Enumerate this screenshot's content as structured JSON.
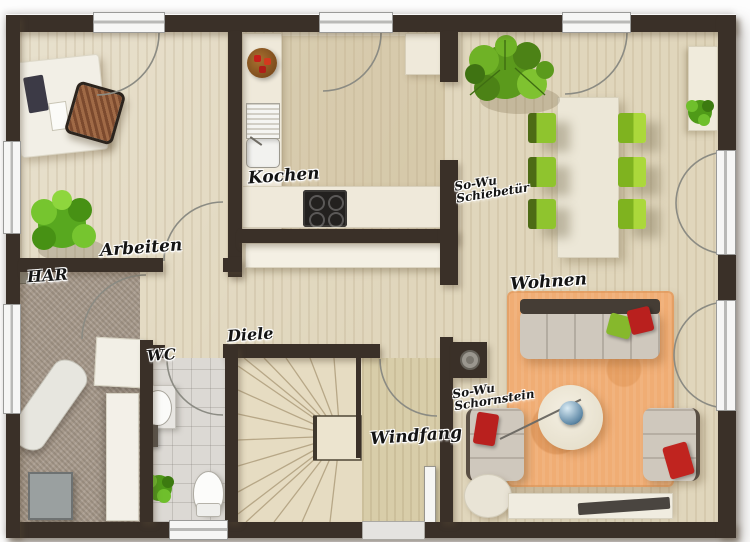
{
  "title": "Erdgeschoss Grundriss",
  "rooms": {
    "arbeiten": {
      "label": "Arbeiten"
    },
    "har": {
      "label": "HAR"
    },
    "kochen": {
      "label": "Kochen"
    },
    "wc": {
      "label": "WC"
    },
    "diele": {
      "label": "Diele"
    },
    "windfang": {
      "label": "Windfang"
    },
    "wohnen": {
      "label": "Wohnen"
    }
  },
  "annotations": {
    "schiebetuer": {
      "line1": "So-Wu",
      "line2": "Schiebetür"
    },
    "schornstein": {
      "line1": "So-Wu",
      "line2": "Schornstein"
    }
  },
  "colors": {
    "wall": "#3a3028",
    "wood_floor": "#e0d6bc",
    "carpet_har": "#a89b8d",
    "tile_wc": "#dcd9d4",
    "chair_green": "#8fc42e",
    "rug_orange": "#f0ad74",
    "pillow_red": "#c0241f",
    "furniture_cream": "#efe9da"
  }
}
